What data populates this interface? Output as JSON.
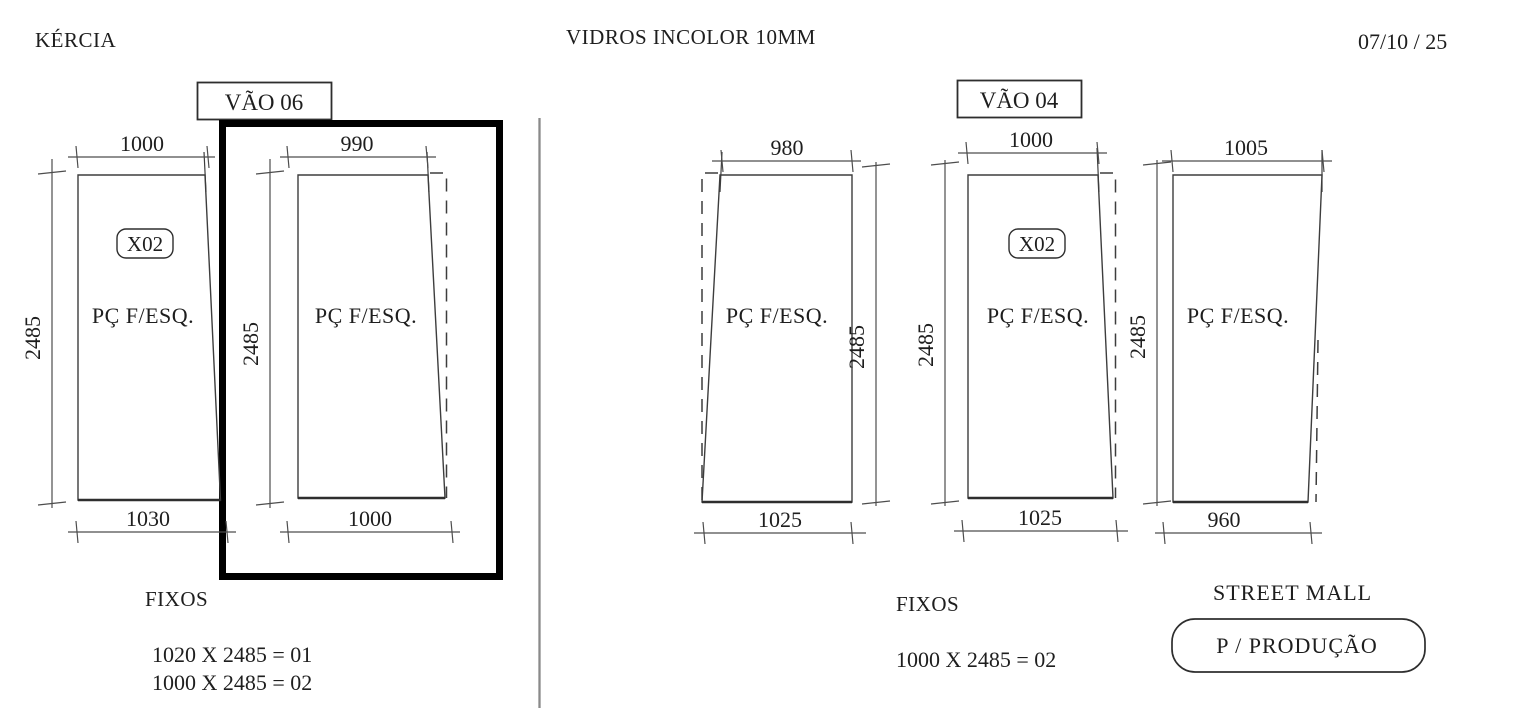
{
  "header": {
    "client": "KÉRCIA",
    "title": "VIDROS INCOLOR 10MM",
    "date": "07/10 / 25"
  },
  "colors": {
    "line": "#3d3d3d",
    "text": "#1e1e1e",
    "highlight_box": "#000000",
    "divider": "#8a8a8a",
    "background": "#ffffff"
  },
  "left_section": {
    "vao_label": "VÃO 06",
    "panels": [
      {
        "top_width": "1000",
        "bottom_width": "1030",
        "height": "2485",
        "tag": "X02",
        "label": "PÇ F/ESQ.",
        "highlighted": false
      },
      {
        "top_width": "990",
        "bottom_width": "1000",
        "height": "2485",
        "label": "PÇ F/ESQ.",
        "highlighted": true
      }
    ],
    "fixos_title": "FIXOS",
    "fixos_lines": [
      "1020 X 2485 = 01",
      "1000 X 2485 = 02"
    ]
  },
  "right_section": {
    "vao_label": "VÃO 04",
    "panels": [
      {
        "top_width": "980",
        "bottom_width": "1025",
        "height": "2485",
        "label": "PÇ F/ESQ.",
        "highlighted": false
      },
      {
        "top_width": "1000",
        "bottom_width": "1025",
        "height": "2485",
        "tag": "X02",
        "label": "PÇ F/ESQ.",
        "highlighted": false
      },
      {
        "top_width": "1005",
        "bottom_width": "960",
        "height": "2485",
        "label": "PÇ F/ESQ.",
        "highlighted": false
      }
    ],
    "fixos_title": "FIXOS",
    "fixos_lines": [
      "1000 X 2485 = 02"
    ],
    "location": "STREET MALL",
    "production_stamp": "P / PRODUÇÃO"
  }
}
